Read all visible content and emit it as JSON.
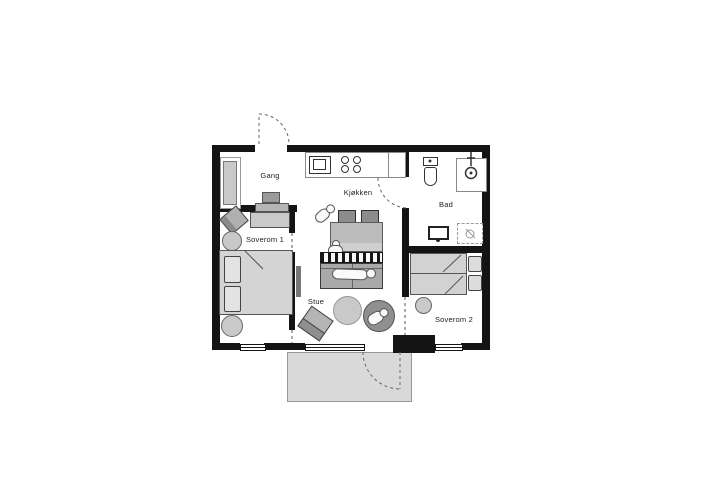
{
  "floorplan": {
    "rooms": [
      {
        "id": "gang",
        "label": "Gang"
      },
      {
        "id": "kjokken",
        "label": "Kjøkken"
      },
      {
        "id": "bad",
        "label": "Bad"
      },
      {
        "id": "soverom1",
        "label": "Soverom 1"
      },
      {
        "id": "stue",
        "label": "Stue"
      },
      {
        "id": "soverom2",
        "label": "Soverom 2"
      }
    ],
    "colors": {
      "wall": "#141414",
      "floor": "#ffffff",
      "furniture_light": "#d4d4d4",
      "furniture_mid": "#bcbcbc",
      "furniture_dark": "#8c8c8c",
      "terrace": "#d9d9d9"
    }
  }
}
